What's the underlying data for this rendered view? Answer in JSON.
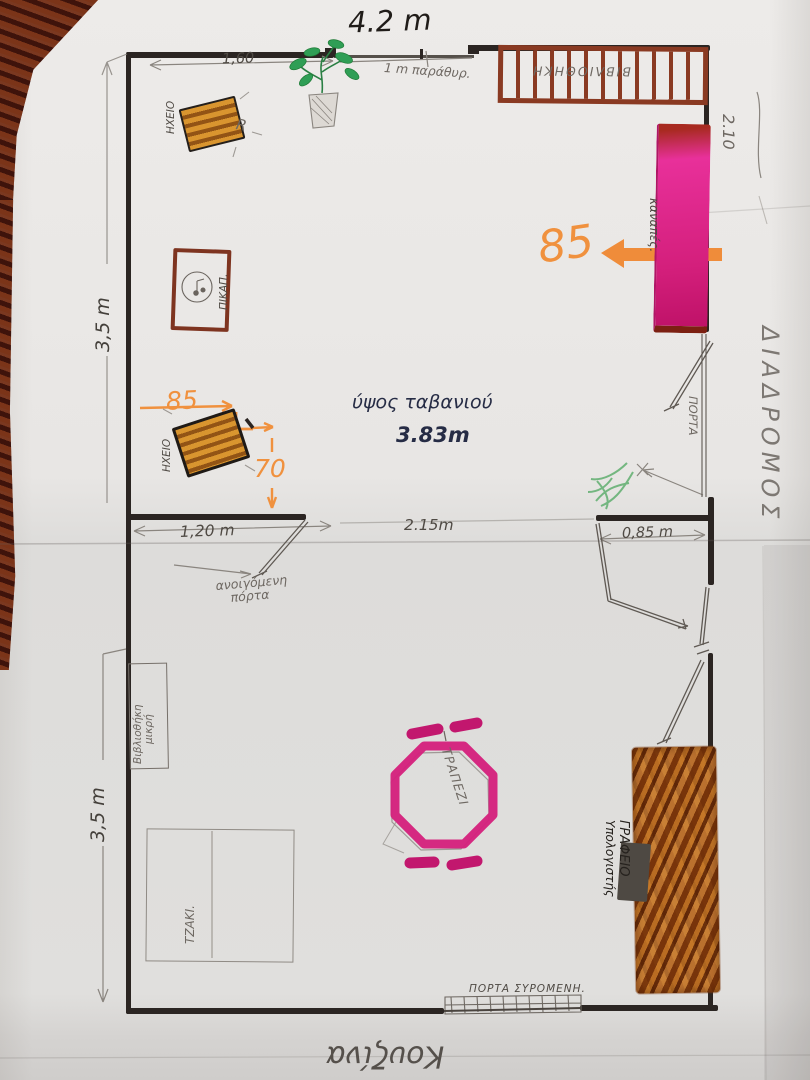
{
  "plan": {
    "title_width": "4.2 m",
    "ceiling": {
      "label": "ύψος ταβανιού",
      "value": "3.83m"
    },
    "dims": {
      "wall_left_segment": "1,60",
      "window": "1 m παράθυρ.",
      "right_wall_depth": "2.10",
      "room_height_upper": "3,5 m",
      "room_height_lower": "3,5 m",
      "door_opening": "1,20 m",
      "middle_opening": "2.15m",
      "right_opening": "0,85 m",
      "sofa_depth": "85",
      "speaker_width": "85",
      "speaker_offset": "70"
    },
    "furniture": {
      "bookshelf_top": "ΒΙΒΛΙΟΘΗΚΗ",
      "sofa": "καναπές.",
      "speaker": "ΗΧΕΙΟ",
      "turntable": "ΠΙΚΑΠ.",
      "bookshelf_small_line1": "Βιβλιοθήκη",
      "bookshelf_small_line2": "μικρή",
      "fireplace": "ΤΖΑΚΙ.",
      "table": "ΤΡΑΠΕΖΙ",
      "desk_line1": "ΓΡΑΦΕΙΟ",
      "desk_line2": "Υπολογιστής"
    },
    "doors": {
      "door_mid_line1": "ανοιγόμενη",
      "door_mid_line2": "πόρτα",
      "door_right": "ΠΟΡΤΑ",
      "sliding": "ΠΟΡΤΑ ΣΥΡΟΜΕΝΗ."
    },
    "areas": {
      "corridor": "ΔΙΑΔΡΟΜΟΣ",
      "kitchen": "Κουζίνα"
    },
    "marks": {
      "r_mark": "R"
    },
    "colors": {
      "wall": "#2b2522",
      "pencil": "#8a857f",
      "ink": "#262c45",
      "orange": "#f0913e",
      "magenta": "#d4217d",
      "brown": "#8a3a22",
      "desk": "#b4671c",
      "green": "#2f9e55",
      "carpet": "#5a1e12",
      "paper": "#e9e7e5"
    }
  }
}
